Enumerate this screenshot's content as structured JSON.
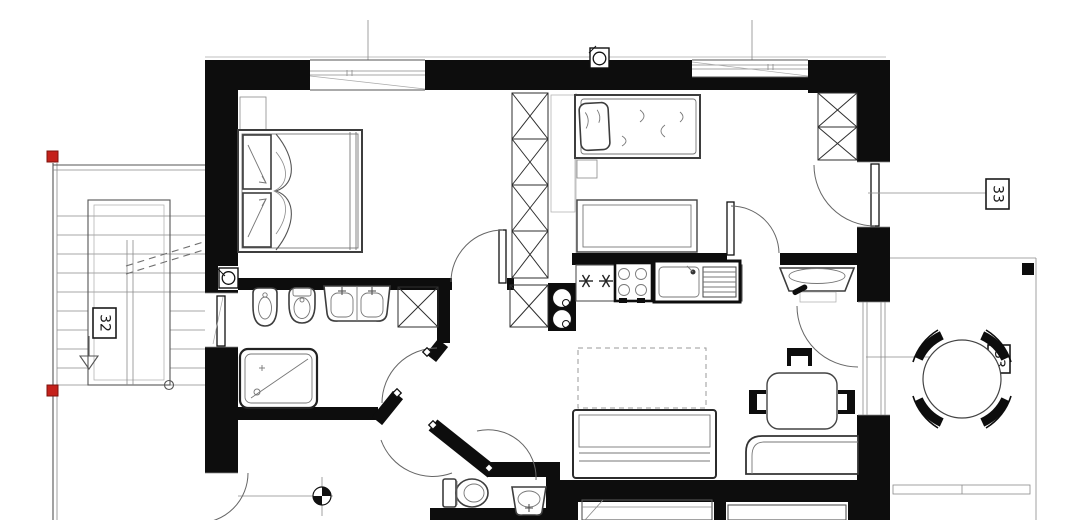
{
  "plan": {
    "type_note": "floor-plan-drawing",
    "labels": {
      "stair_area": "32",
      "entry_door": "33",
      "terrace_window": "33"
    },
    "colors": {
      "wall": "#0d0d0d",
      "line": "#555555",
      "marker_red": "#c4211b",
      "background": "#ffffff"
    },
    "icons": [
      "vent-fan-icon",
      "survey-benchmark-icon",
      "red-marker-icon",
      "stair-direction-arrow-icon",
      "hob-burner-marks",
      "door-swing-arc",
      "wardrobe-x-symbol"
    ]
  }
}
